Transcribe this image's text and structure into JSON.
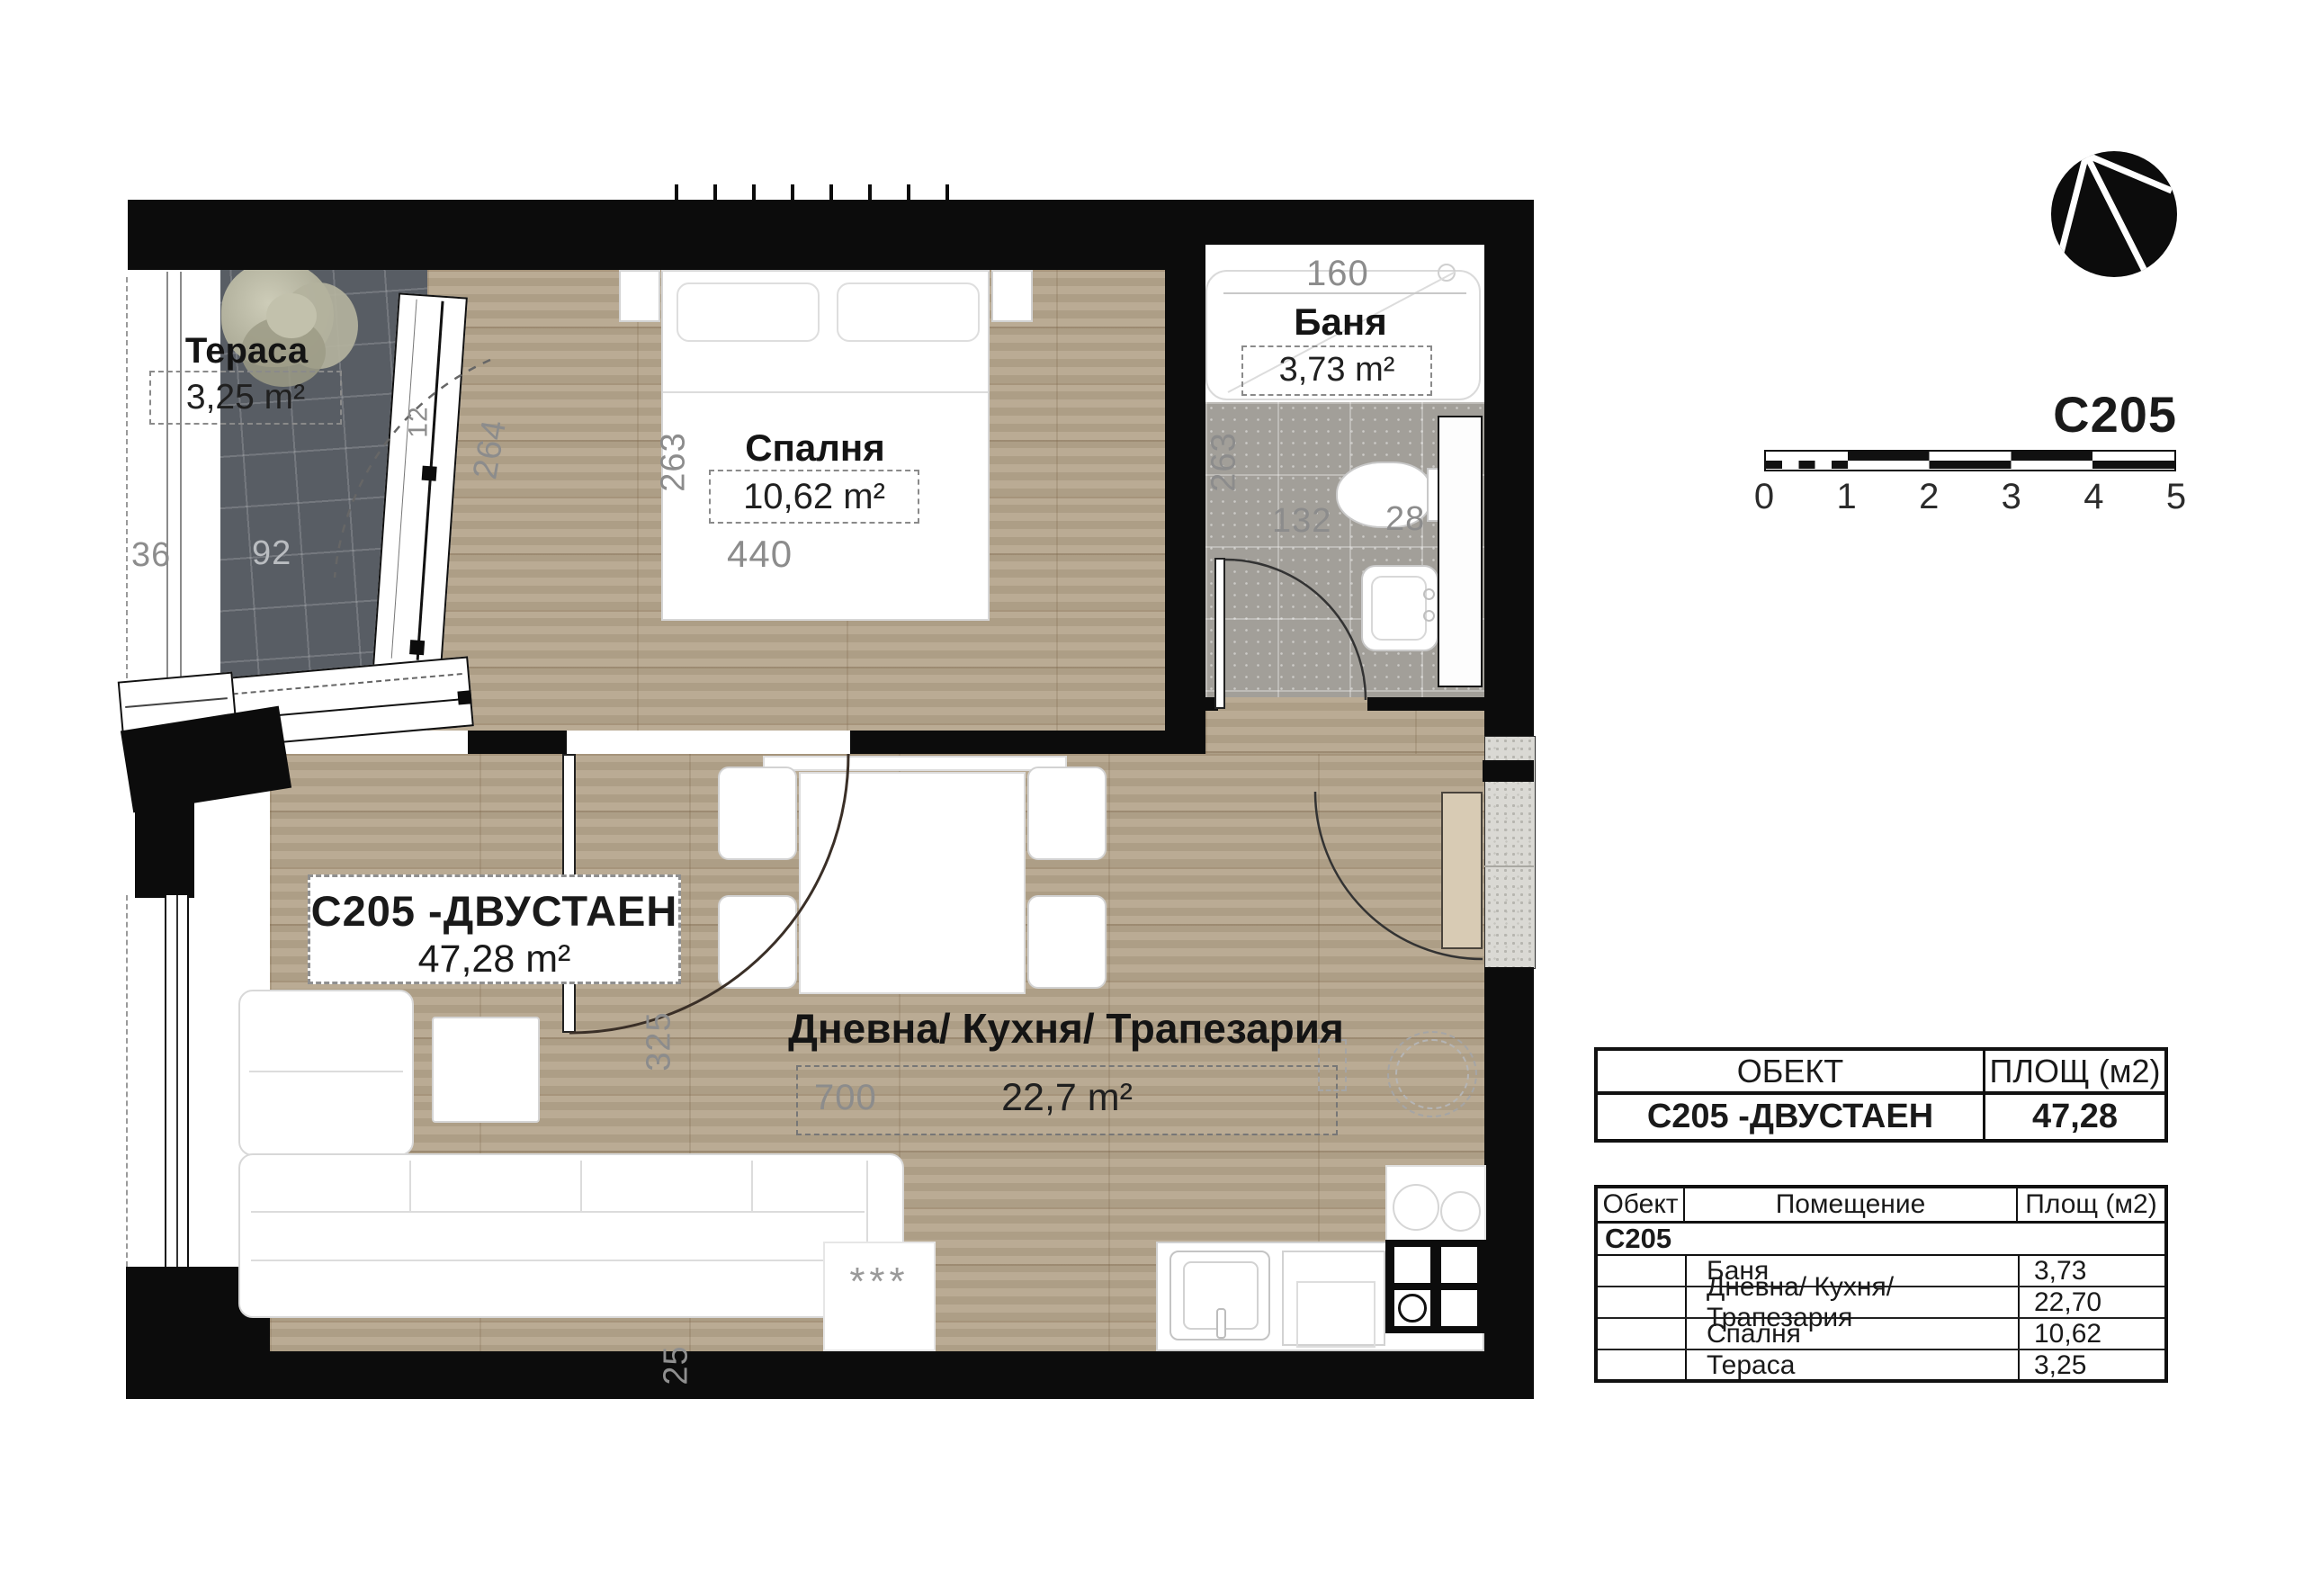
{
  "header": {
    "unit_code": "C205"
  },
  "plan": {
    "rooms": {
      "terrace": {
        "name": "Тераса",
        "area": "3,25 m²"
      },
      "bedroom": {
        "name": "Спалня",
        "area": "10,62 m²"
      },
      "bathroom": {
        "name": "Баня",
        "area": "3,73 m²"
      },
      "living": {
        "name": "Дневна/ Кухня/ Трапезария",
        "area": "22,7 m²"
      }
    },
    "unit_label": {
      "title": "C205 -ДВУСТАЕН",
      "area": "47,28 m²"
    },
    "dims": {
      "terrace_w": "36",
      "terrace_l": "92",
      "terrace_door": "264",
      "partition": "12",
      "bedroom_h": "263",
      "bedroom_w": "440",
      "bath_w": "160",
      "bath_h": "263",
      "bath_fix1": "132",
      "bath_fix2": "28",
      "living_w": "700",
      "living_h": "325",
      "wall_t": "25"
    },
    "rug_marks": "***"
  },
  "scalebar": {
    "ticks": [
      "0",
      "1",
      "2",
      "3",
      "4",
      "5"
    ]
  },
  "summary_table": {
    "col_object": "ОБЕКТ",
    "col_area": "ПЛОЩ (м2)",
    "row_object": "C205 -ДВУСТАЕН",
    "row_area": "47,28"
  },
  "breakdown_table": {
    "col_object": "Обект",
    "col_room": "Помещение",
    "col_area": "Площ (м2)",
    "group": "C205",
    "rows": [
      {
        "room": "Баня",
        "area": "3,73"
      },
      {
        "room": "Дневна/ Кухня/ Трапезария",
        "area": "22,70"
      },
      {
        "room": "Спалня",
        "area": "10,62"
      },
      {
        "room": "Тераса",
        "area": "3,25"
      }
    ]
  },
  "colors": {
    "wall": "#0c0c0c",
    "wood": "#b5a58c",
    "terrace_tile": "#585d64",
    "bath_tile": "#a29f99",
    "granite": "#dad9d4"
  }
}
